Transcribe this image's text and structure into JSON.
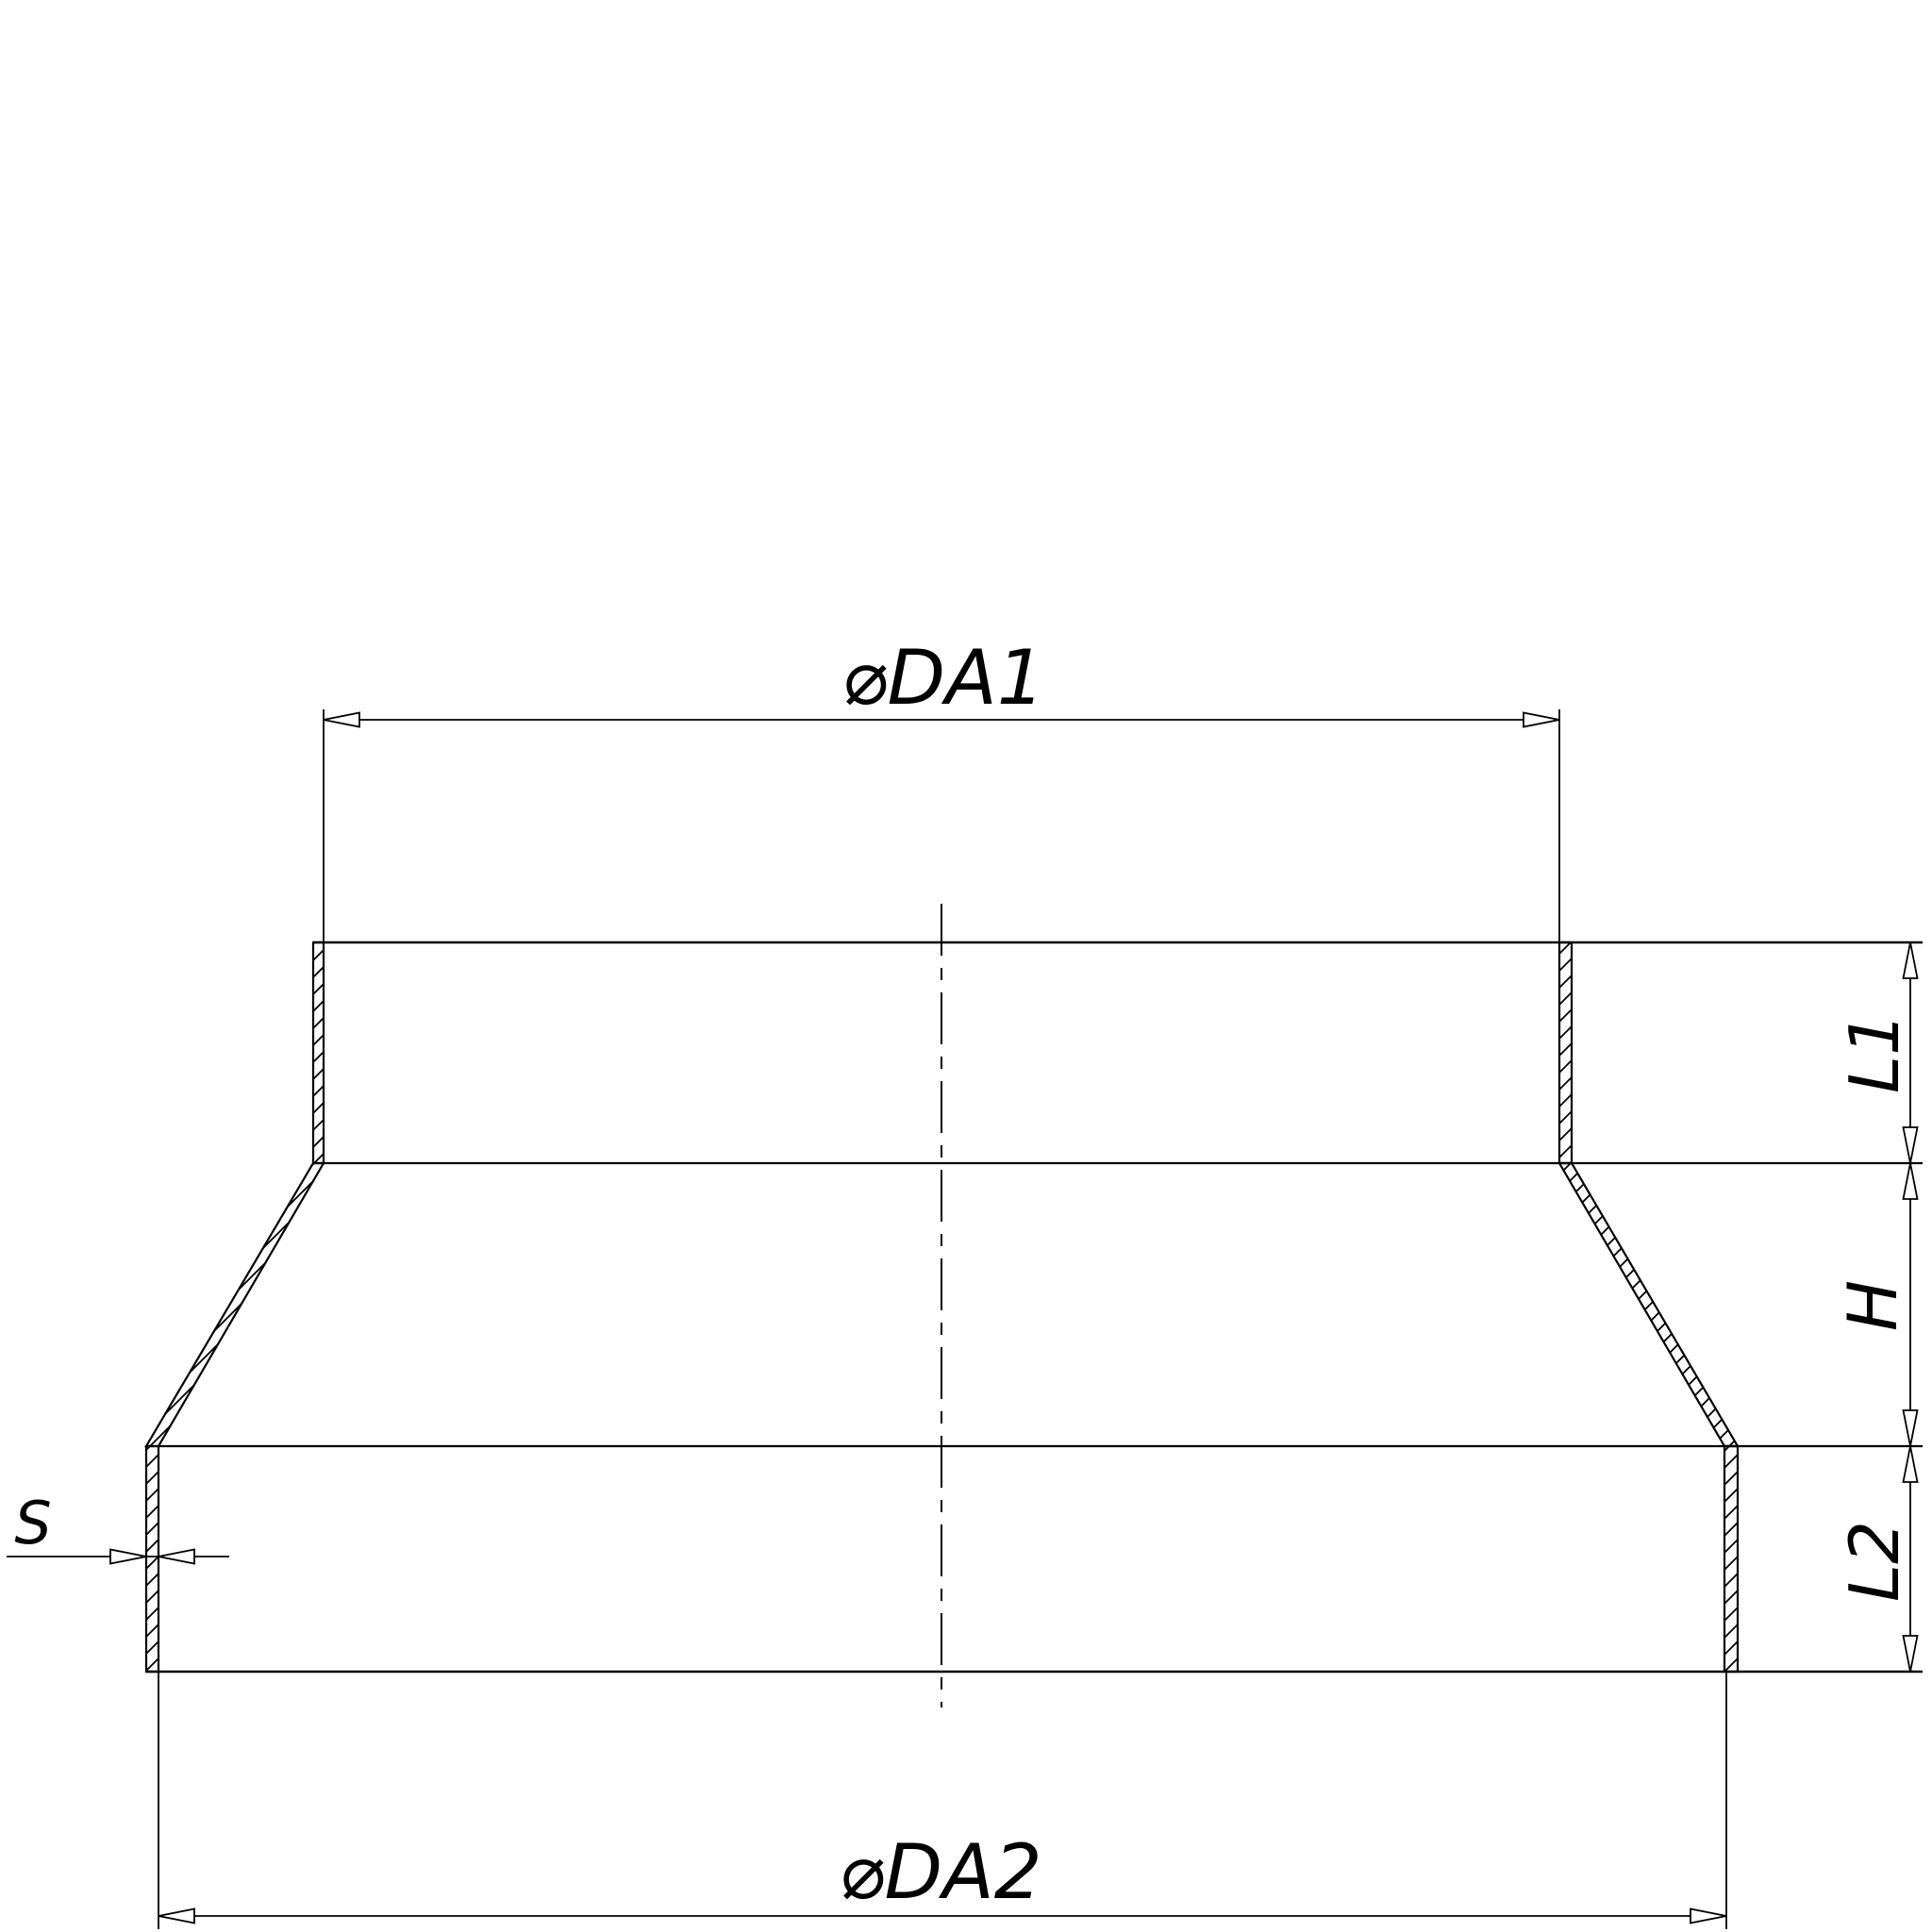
{
  "drawing": {
    "background": "#ffffff",
    "line_color": "#000000",
    "labels": {
      "top_diameter": "⌀DA1",
      "bottom_diameter": "⌀DA2",
      "upper_collar_length": "L1",
      "cone_height": "H",
      "lower_collar_length": "L2",
      "wall_thickness": "S"
    }
  }
}
